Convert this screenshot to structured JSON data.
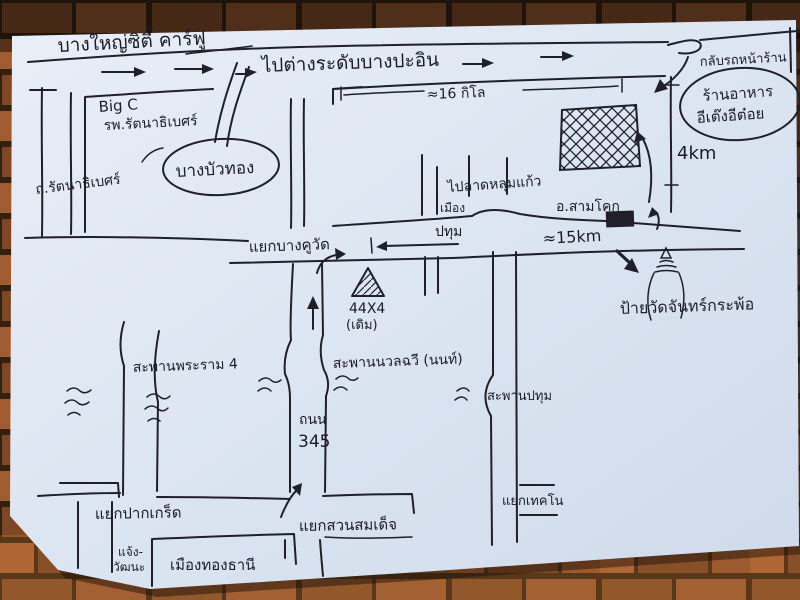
{
  "labels": {
    "title": "บางใหญ่ซิตี้ คาร์ฟู",
    "to_bang_pa_in": "ไปต่างระดับบางปะอิน",
    "uturn_note": "กลับรถหน้าร้าน",
    "restaurant_line1": "ร้านอาหาร",
    "restaurant_line2": "อีเต๊งอีต๋อย",
    "dist_4km": "4km",
    "big_c": "Big C",
    "hospital": "รพ.รัตนาธิเบศร์",
    "rattanathibet_road": "ถ.รัตนาธิเบศร์",
    "bang_bua_thong": "บางบัวทอง",
    "dist_16km": "≈16 กิโล",
    "to_lat_lum_kaeo": "ไปลาดหลุมแก้ว",
    "mueang": "เมือง",
    "pathum": "ปทุม",
    "sam_khok": "อ.สามโคก",
    "dist_15km": "≈15km",
    "bang_khu_wat_junction": "แยกบางคูวัด",
    "landmark_44x4": "44X4",
    "landmark_44x4_note": "(เดิม)",
    "wat_chan_sign": "ป้ายวัดจันทร์กระพ้อ",
    "rama4_bridge": "สะพานพระราม 4",
    "nuan_chawi_bridge": "สะพานนวลฉวี (นนท์)",
    "pathum_bridge": "สะพานปทุม",
    "road_345_word": "ถนน",
    "road_345_num": "345",
    "pak_kret_junction": "แยกปากเกร็ด",
    "chaeng_line1": "แจ้ง-",
    "chaeng_line2": "วัฒนะ",
    "mueang_thong_thani": "เมืองทองธานี",
    "suan_somdet_junction": "แยกสวนสมเด็จ",
    "techno_junction": "แยกเทคโน"
  },
  "colors": {
    "ink": "#20202a",
    "paper": "#dfe7f2",
    "brick": "#8e5330"
  }
}
